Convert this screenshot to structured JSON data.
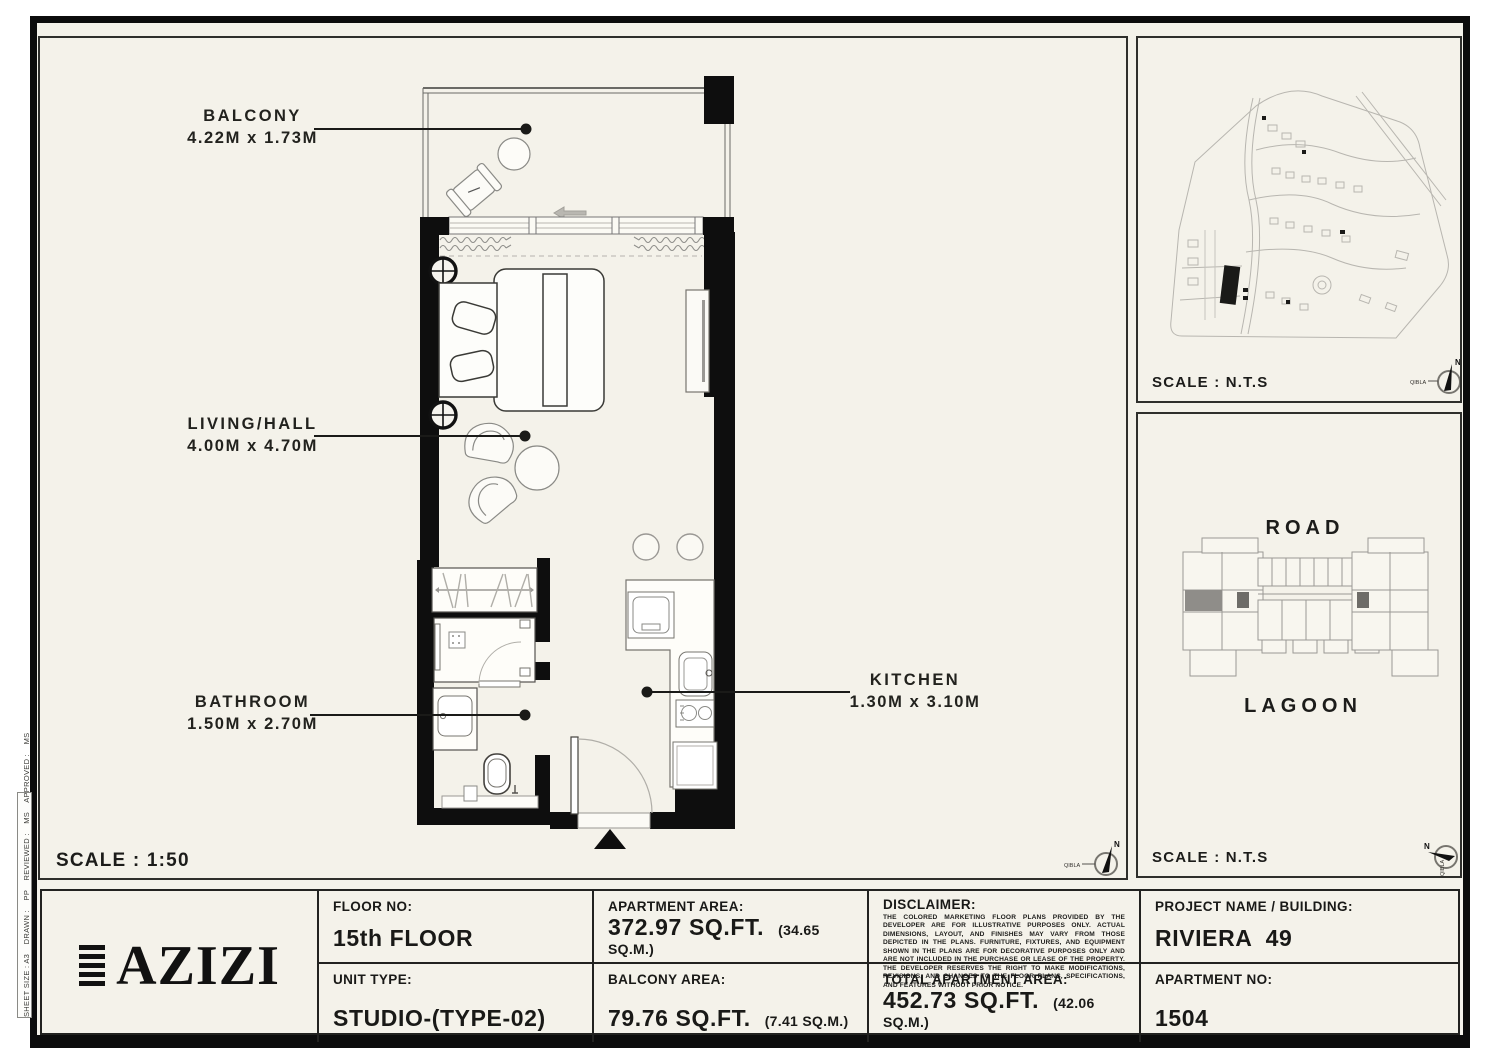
{
  "sheet": {
    "side_strip": "SHEET SIZE : A3    DRAWN :    PP    REVIEWED :    MS    APPROVED :    MS",
    "compass": {
      "north": "N",
      "qibla": "QIBLA"
    }
  },
  "floor_plan_panel": {
    "scale": "SCALE : 1:50",
    "rooms": [
      {
        "name": "BALCONY",
        "dims": "4.22M x 1.73M"
      },
      {
        "name": "LIVING/HALL",
        "dims": "4.00M x 4.70M"
      },
      {
        "name": "BATHROOM",
        "dims": "1.50M x 2.70M"
      },
      {
        "name": "KITCHEN",
        "dims": "1.30M x 3.10M"
      }
    ]
  },
  "site_plan_panel": {
    "scale": "SCALE : N.T.S"
  },
  "key_plan_panel": {
    "scale": "SCALE : N.T.S",
    "road": "ROAD",
    "lagoon": "LAGOON"
  },
  "title_block": {
    "logo_text": "AZIZI",
    "floor_no": {
      "label": "FLOOR NO:",
      "value": "15th FLOOR"
    },
    "unit_type": {
      "label": "UNIT TYPE:",
      "value": "STUDIO-(TYPE-02)"
    },
    "apartment_area": {
      "label": "APARTMENT AREA:",
      "value": "372.97 SQ.FT.",
      "metric": "(34.65 SQ.M.)"
    },
    "balcony_area": {
      "label": "BALCONY AREA:",
      "value": "79.76 SQ.FT.",
      "metric": "(7.41 SQ.M.)"
    },
    "disclaimer": {
      "label": "DISCLAIMER:",
      "text": "THE COLORED MARKETING FLOOR PLANS PROVIDED BY THE DEVELOPER ARE FOR ILLUSTRATIVE PURPOSES ONLY. ACTUAL DIMENSIONS, LAYOUT, AND FINISHES MAY VARY FROM THOSE DEPICTED IN THE PLANS. FURNITURE, FIXTURES, AND EQUIPMENT SHOWN IN THE PLANS ARE FOR DECORATIVE PURPOSES ONLY AND ARE NOT INCLUDED IN THE PURCHASE OR LEASE OF THE PROPERTY. THE DEVELOPER RESERVES THE RIGHT TO MAKE MODIFICATIONS, REVISIONS, AND CHANGES TO THE FLOOR PLANS, SPECIFICATIONS, AND FEATURES WITHOUT PRIOR NOTICE."
    },
    "total_area": {
      "label": "TOTAL APARTMENT AREA:",
      "value": "452.73 SQ.FT.",
      "metric": "(42.06 SQ.M.)"
    },
    "project": {
      "label": "PROJECT NAME / BUILDING:",
      "value": "RIVIERA  49"
    },
    "apartment_no": {
      "label": "APARTMENT NO:",
      "value": "1504"
    }
  },
  "colors": {
    "paper": "#F4F2EA",
    "ink": "#111111",
    "unit_highlight": "#8F8D89"
  }
}
